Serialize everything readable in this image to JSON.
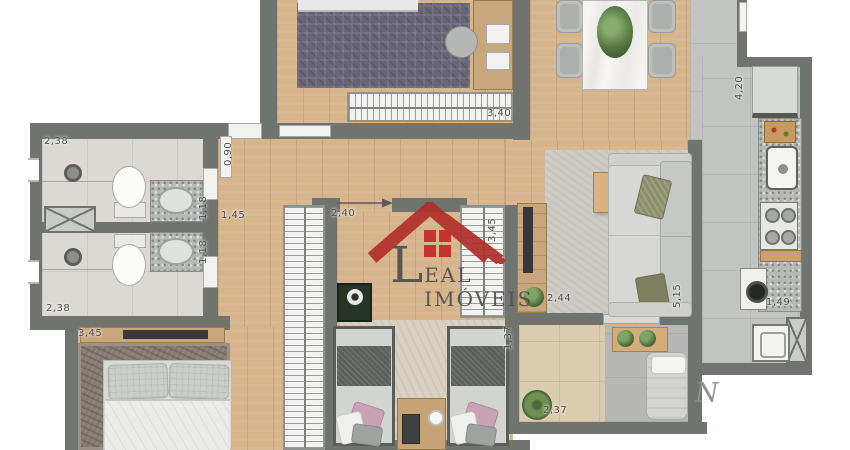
{
  "watermark": {
    "brand_initial": "L",
    "brand_rest": "EAL IMÓVEIS",
    "roof_color": "#b1302c",
    "text_color": "#4f4f4f"
  },
  "north_mark": "N",
  "labels": [
    {
      "id": "bath1-width",
      "value": "2,38"
    },
    {
      "id": "bath1-sink",
      "value": "1,18"
    },
    {
      "id": "bath2-sink",
      "value": "1,18"
    },
    {
      "id": "bath2-width",
      "value": "2,38"
    },
    {
      "id": "master-width",
      "value": "3,45"
    },
    {
      "id": "hall-width",
      "value": "0,90"
    },
    {
      "id": "corridor-width",
      "value": "1,45"
    },
    {
      "id": "hall-length",
      "value": "2,40"
    },
    {
      "id": "bedroom2-wardrobe-length",
      "value": "3,45"
    },
    {
      "id": "bedroom1-width",
      "value": "3,40"
    },
    {
      "id": "kitchen-length",
      "value": "4,20"
    },
    {
      "id": "laundry-width",
      "value": "1,49"
    },
    {
      "id": "living-width",
      "value": "2,44"
    },
    {
      "id": "living-length",
      "value": "5,15"
    },
    {
      "id": "balcony-depth",
      "value": "1,37"
    },
    {
      "id": "balcony-width",
      "value": "2,37"
    }
  ],
  "colors": {
    "wall": "#70746f",
    "wood_floor": "#d6b58d",
    "bath_tile": "#dcd9d4",
    "kitchen_tile": "#c2c4c1",
    "logo_red": "#b1302c"
  }
}
